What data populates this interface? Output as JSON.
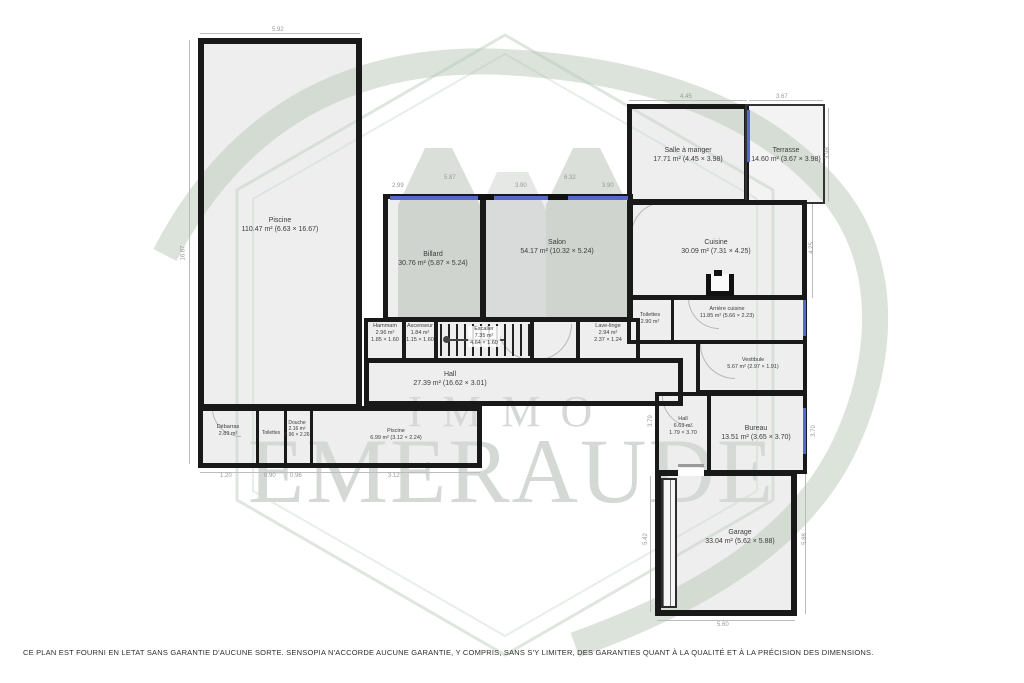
{
  "watermark": {
    "line1": "IMMO",
    "line2": "EMERAUDE"
  },
  "rooms": {
    "piscine": {
      "name": "Piscine",
      "area": "110.47 m² (6.63 × 16.67)"
    },
    "billard": {
      "name": "Billard",
      "area": "30.76 m² (5.87 × 5.24)"
    },
    "salon": {
      "name": "Salon",
      "area": "54.17 m² (10.32 × 5.24)"
    },
    "salle_a_manger": {
      "name": "Salle à manger",
      "area": "17.71 m² (4.45 × 3.98)"
    },
    "terrasse": {
      "name": "Terrasse",
      "area": "14.60 m² (3.67 × 3.98)"
    },
    "cuisine": {
      "name": "Cuisine",
      "area": "30.09 m² (7.31 × 4.25)"
    },
    "arriere_cuisine": {
      "name": "Arrière cuisine",
      "area": "11.85 m² (5.66 × 2.23)"
    },
    "toilettes_cuisine": {
      "name": "Toilettes",
      "area": "2.90 m²"
    },
    "vestibule": {
      "name": "Vestibule",
      "area": "5.67 m² (2.97 × 1.91)"
    },
    "lave_linge": {
      "name": "Lave-linge",
      "area": "2.94 m²",
      "dims": "2.37 × 1.24"
    },
    "hammam": {
      "name": "Hammam",
      "area": "2.96 m²",
      "dims": "1.85 × 1.60"
    },
    "ascenseur": {
      "name": "Ascenseur",
      "area": "1.84 m²",
      "dims": "1.15 × 1.60"
    },
    "escalier": {
      "name": "Escalier",
      "area": "7.35 m²",
      "dims": "4.64 × 1.60"
    },
    "hall": {
      "name": "Hall",
      "area": "27.39 m² (16.62 × 3.01)"
    },
    "hall_2": {
      "name": "Hall",
      "area": "6.63 m²",
      "dims": "1.79 × 3.70"
    },
    "bureau": {
      "name": "Bureau",
      "area": "13.51 m² (3.65 × 3.70)"
    },
    "garage": {
      "name": "Garage",
      "area": "33.04 m² (5.62 × 5.88)"
    },
    "debarras": {
      "name": "Débarras",
      "area": "2.89 m²"
    },
    "toilettes_piscine": {
      "name": "Toilettes"
    },
    "douche": {
      "name": "Douche",
      "area": "2.16 m²",
      "dims": "0.96 × 2.26"
    },
    "piscine_petite": {
      "name": "Piscine",
      "area": "6.99 m² (3.12 × 2.24)"
    }
  },
  "dims": {
    "piscine_l": "5.92",
    "piscine_h": "16.67",
    "sam_w": "4.45",
    "terrasse_w": "3.67",
    "terrasse_h": "3.98",
    "cuisine_h": "4.25",
    "d_299": "2.99",
    "billard_w": "5.87",
    "d_390a": "3.90",
    "salon_w": "6.32",
    "d_390b": "3.90",
    "hall2_h": "3.79",
    "bureau_h": "3.70",
    "garage_l": "5.42",
    "garage_r": "5.88",
    "garage_w": "5.60",
    "annex_1": "1.20",
    "annex_2": "0.90",
    "annex_3": "0.96",
    "annex_4": "3.12"
  },
  "disclaimer": "CE PLAN EST FOURNI EN LETAT SANS GARANTIE D'AUCUNE SORTE. SENSOPIA N'ACCORDE AUCUNE GARANTIE, Y COMPRIS, SANS S'Y LIMITER, DES GARANTIES QUANT À LA QUALITÉ ET À LA PRÉCISION DES DIMENSIONS.",
  "colors": {
    "wall": "#191919",
    "window": "#5668c9",
    "watermark_text": "#d5d9d5",
    "logo_outline": "#c9d6c9",
    "ribbon": "#b8c8b8",
    "room_fill": "#eeeeef"
  }
}
